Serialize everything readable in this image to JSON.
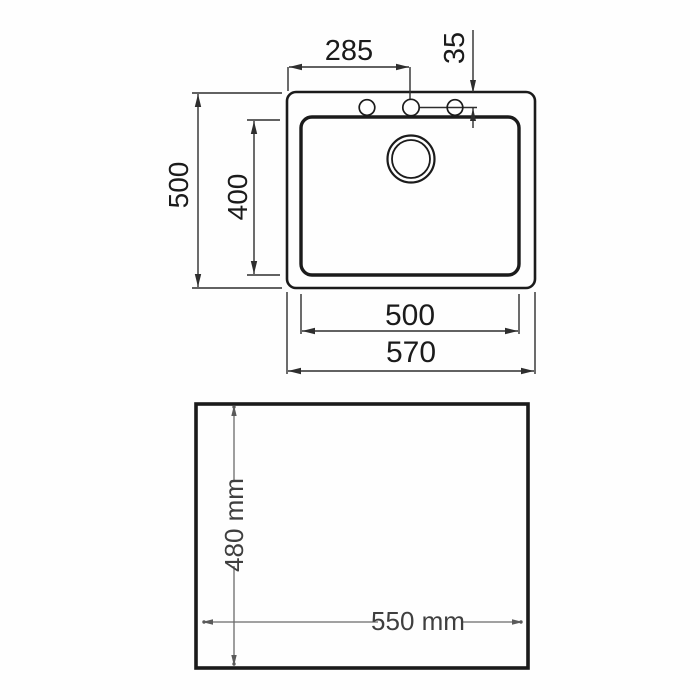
{
  "diagram": {
    "type": "technical-drawing",
    "subject": "sink-top-view-and-cutout-template",
    "colors": {
      "background": "#fefefe",
      "outline": "#1b1b1b",
      "dimension_line": "#2e2e2e",
      "cutout_dimension_line": "#6a6a6a",
      "cutout_dimension_text": "#3f3f3f"
    },
    "top_view": {
      "dims": {
        "faucet_offset": "285",
        "hole_inset": "35",
        "overall_depth": "500",
        "bowl_depth": "400",
        "bowl_width": "500",
        "overall_width": "570"
      }
    },
    "cutout_view": {
      "dims": {
        "height": "480 mm",
        "width": "550 mm"
      }
    }
  }
}
